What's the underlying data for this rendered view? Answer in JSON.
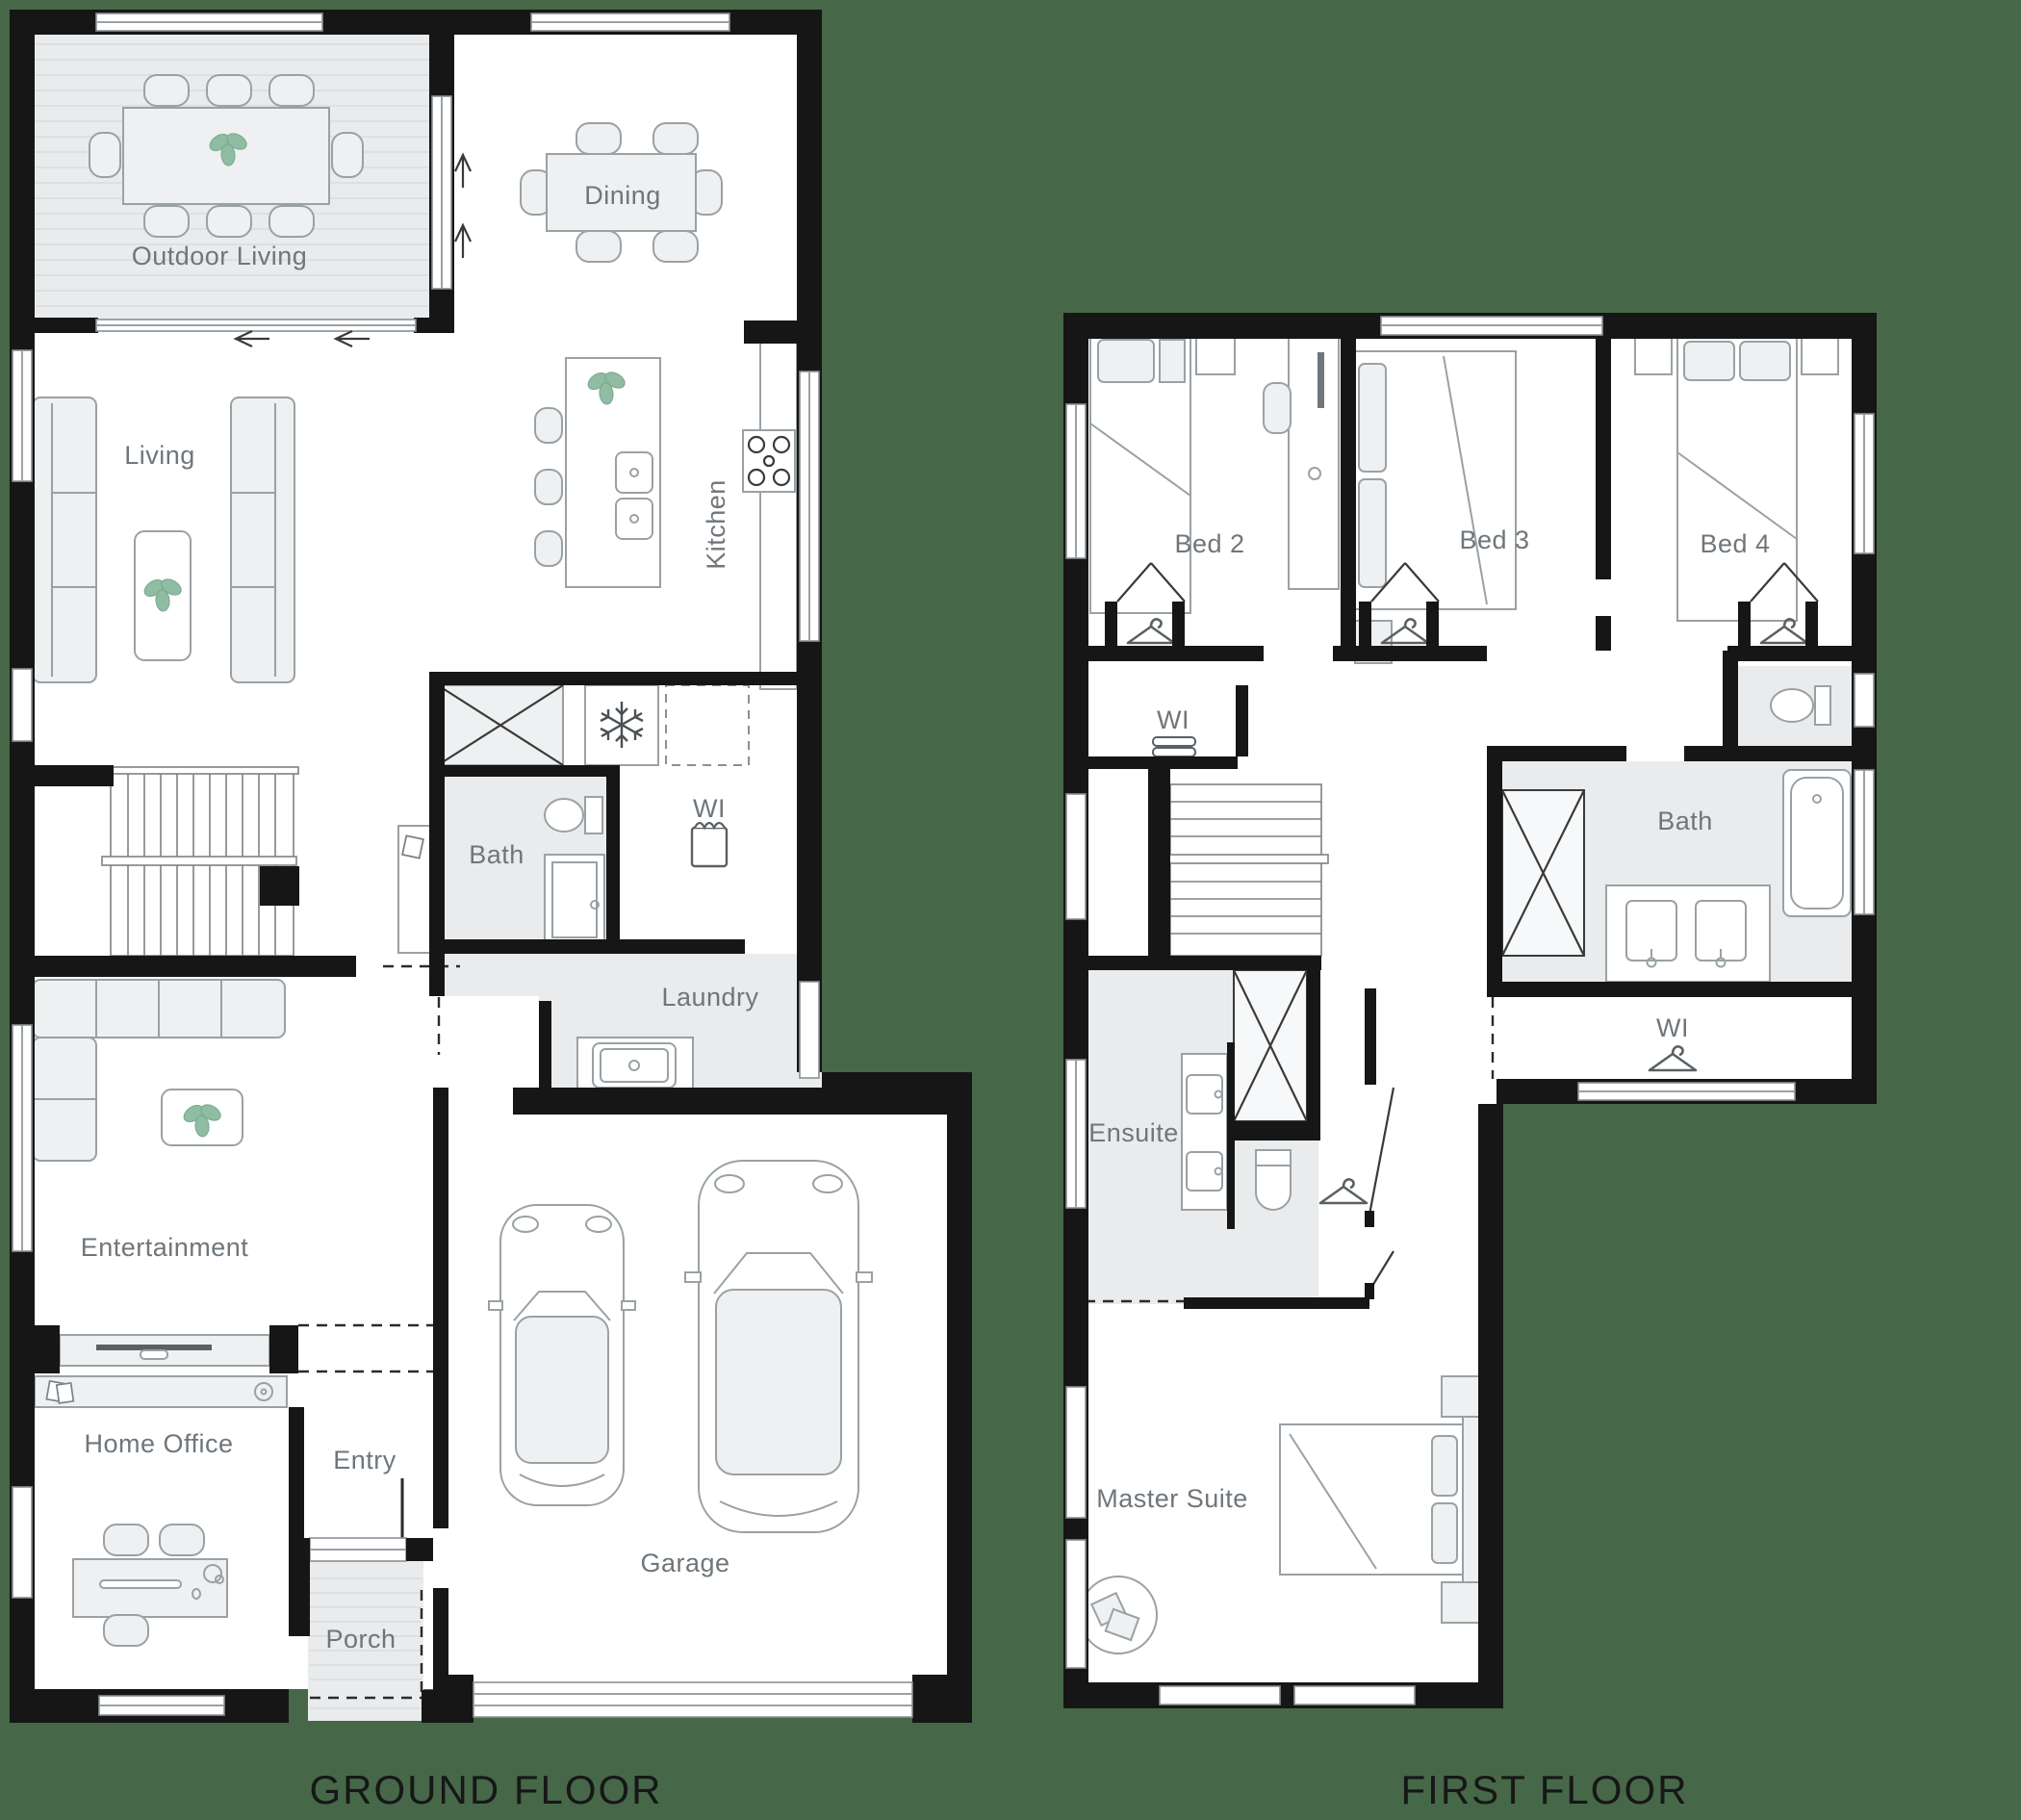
{
  "page": {
    "background_color": "#466848",
    "type": "architectural floor plan, two storeys"
  },
  "palette": {
    "wall": "#161616",
    "room_fill": "#FFFFFF",
    "tiled_fill": "#E9EBEC",
    "furniture_stroke": "#9AA1A5",
    "label_text": "#6F767B",
    "title_text": "#171717",
    "plant_green": "#8FBCA2"
  },
  "ground_floor": {
    "title": "GROUND FLOOR",
    "rooms": {
      "outdoor_living": {
        "label": "Outdoor Living"
      },
      "dining": {
        "label": "Dining"
      },
      "living": {
        "label": "Living"
      },
      "kitchen": {
        "label": "Kitchen"
      },
      "bath": {
        "label": "Bath"
      },
      "wi": {
        "label": "WI"
      },
      "laundry": {
        "label": "Laundry"
      },
      "entertainment": {
        "label": "Entertainment"
      },
      "home_office": {
        "label": "Home Office"
      },
      "entry": {
        "label": "Entry"
      },
      "porch": {
        "label": "Porch"
      },
      "garage": {
        "label": "Garage"
      }
    }
  },
  "first_floor": {
    "title": "FIRST FLOOR",
    "rooms": {
      "bed2": {
        "label": "Bed 2"
      },
      "bed3": {
        "label": "Bed 3"
      },
      "bed4": {
        "label": "Bed 4"
      },
      "wi_landing": {
        "label": "WI"
      },
      "bath": {
        "label": "Bath"
      },
      "wi_master": {
        "label": "WI"
      },
      "ensuite": {
        "label": "Ensuite"
      },
      "master_suite": {
        "label": "Master Suite"
      }
    }
  },
  "icons": {
    "plant": "potted-plant top view",
    "snowflake": "fridge space ❄",
    "hanger": "wardrobe coat-hanger",
    "towels": "stacked linen shelves",
    "shopping_bag": "walk-in pantry bag",
    "cooktop": "gas cooktop burners",
    "sink": "basin with tap",
    "toilet": "toilet suite",
    "bathtub": "bathtub",
    "shower": "shower (crossed box)",
    "stairs": "staircase treads",
    "car": "car top view",
    "arrow": "door / drainage direction arrow"
  }
}
